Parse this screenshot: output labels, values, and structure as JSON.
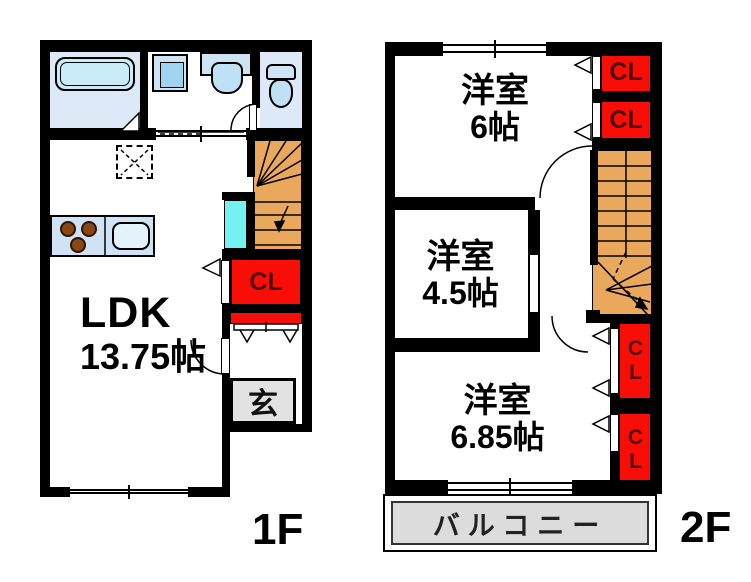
{
  "f1": {
    "floor_label": "1F",
    "ldk_name": "LDK",
    "ldk_size": "13.75帖",
    "closet_label": "CL",
    "entrance_label": "玄"
  },
  "f2": {
    "floor_label": "2F",
    "room_top": {
      "name": "洋室",
      "size": "6帖"
    },
    "room_mid": {
      "name": "洋室",
      "size": "4.5帖"
    },
    "room_bottom": {
      "name": "洋室",
      "size": "6.85帖"
    },
    "closets": [
      "CL",
      "CL",
      "CL",
      "CL"
    ],
    "balcony_label": "バルコニー"
  },
  "colors": {
    "wall_black": "#000000",
    "closet_red": "#f90d07",
    "stairs_orange": "#e9a85b",
    "room_floor_blue": "#dde9f6",
    "fixture_blue": "#cfe3f5",
    "bathtub_cyan": "#c9ecf8",
    "pipe_space_cyan": "#76f1f1",
    "entrance_gray": "#e2e2e2",
    "balcony_gray": "#dcdcdc"
  }
}
